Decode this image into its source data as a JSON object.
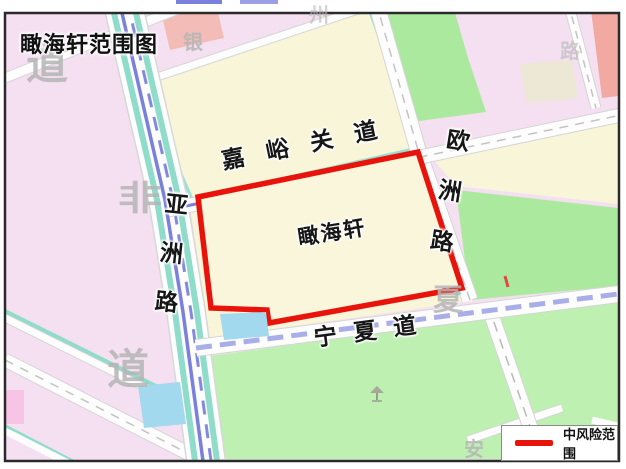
{
  "title": "瞰海轩范围图",
  "area": {
    "name": "瞰海轩",
    "outline_color": "#e8140c"
  },
  "roads": {
    "jiayuguan": "嘉峪关道",
    "ouzhou": "欧洲路",
    "yazhou": "亚洲路",
    "ningxia": "宁夏道"
  },
  "legend": {
    "label": "中风险范围",
    "line_color": "#e8140c"
  },
  "watermarks": [
    {
      "glyph": "道"
    },
    {
      "glyph": "银"
    },
    {
      "glyph": "州"
    },
    {
      "glyph": "路"
    },
    {
      "glyph": "非"
    },
    {
      "glyph": "道"
    },
    {
      "glyph": "夏"
    },
    {
      "glyph": "安"
    }
  ],
  "colors": {
    "risk_red": "#e8140c",
    "block_pink": "#f5e0f2",
    "block_cream": "#f9f5d8",
    "block_green": "#abe99e",
    "block_green_south": "#bdf0b1",
    "block_salmon": "#f2a9a1",
    "water_blue": "#a3d9ee",
    "canal_teal": "#8edcc9",
    "transit_blue": "#7b80dc",
    "transit_purple": "#a9aee9"
  }
}
